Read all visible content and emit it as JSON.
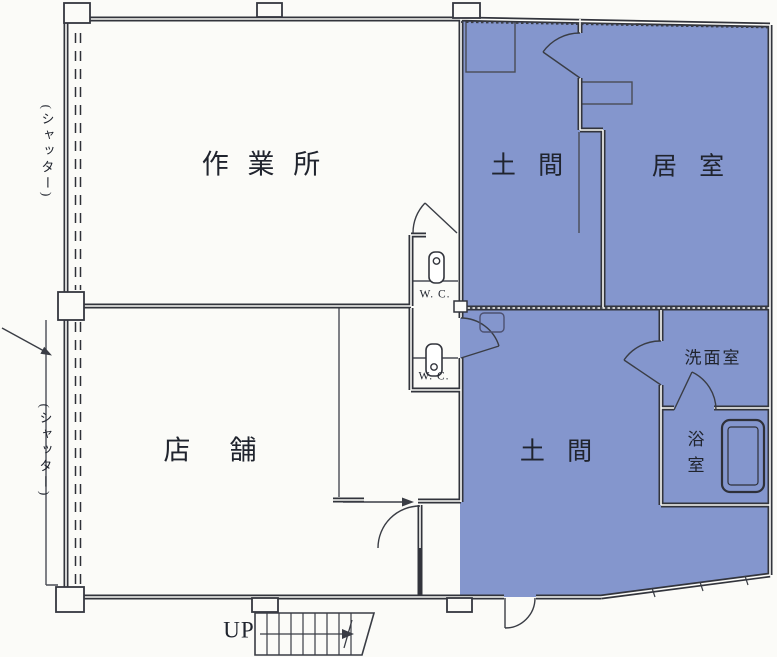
{
  "plan": {
    "colors": {
      "highlight": "#8496cd",
      "wall": "#32343c",
      "paper": "#fbfbf8",
      "thin_line": "#4a4d55",
      "text": "#20242e"
    },
    "rooms": [
      {
        "id": "workshop",
        "label": "作 業 所",
        "highlighted": false
      },
      {
        "id": "shop",
        "label": "店　舗",
        "highlighted": false
      },
      {
        "id": "doma-upper",
        "label": "土 間",
        "highlighted": true
      },
      {
        "id": "living-room",
        "label": "居 室",
        "highlighted": true
      },
      {
        "id": "doma-lower",
        "label": "土 間",
        "highlighted": true
      },
      {
        "id": "washroom",
        "label": "洗面室",
        "highlighted": true
      },
      {
        "id": "bathroom",
        "label": "浴室",
        "highlighted": true
      },
      {
        "id": "wc-upper",
        "label": "W. C.",
        "highlighted": false
      },
      {
        "id": "wc-lower",
        "label": "W. C.",
        "highlighted": false
      }
    ],
    "annotations": {
      "shutter_upper": "(シャッター)",
      "shutter_lower": "(シャッター)",
      "stairs_up": "UP"
    }
  }
}
